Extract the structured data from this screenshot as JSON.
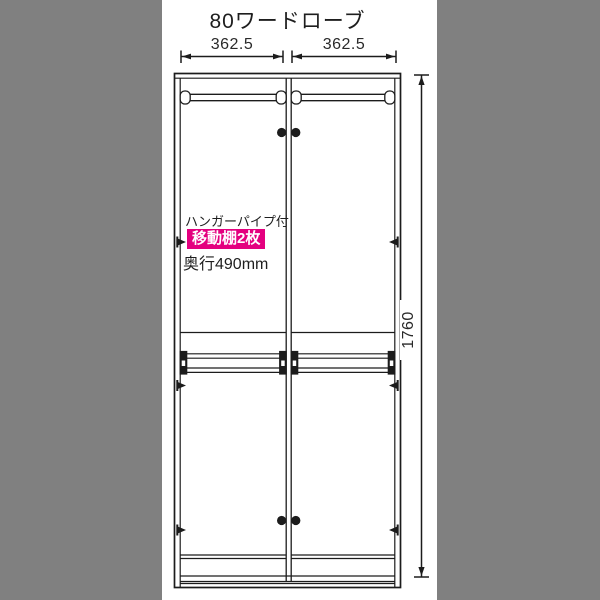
{
  "diagram": {
    "title": "80ワードローブ",
    "dimensions": {
      "width_left": "362.5",
      "width_right": "362.5",
      "height": "1760"
    },
    "annotations": {
      "hanger_pipe": "ハンガーパイプ付",
      "movable_shelves": "移動棚2枚",
      "depth": "奥行490mm"
    },
    "colors": {
      "highlight_badge": "#e4007f",
      "line": "#1c1c1c",
      "side_mask": "#808080"
    }
  }
}
